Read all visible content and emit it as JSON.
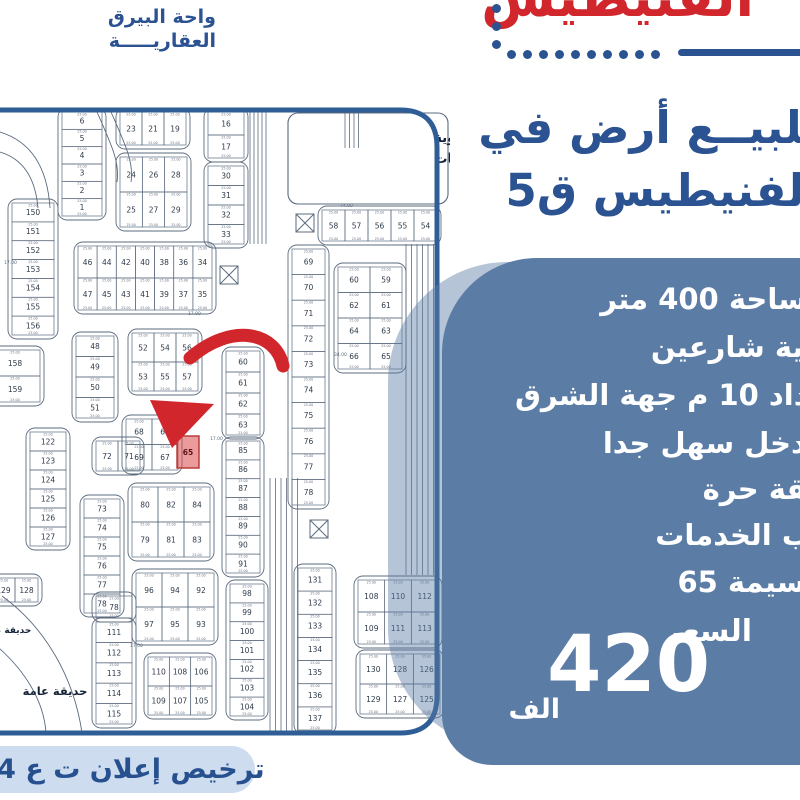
{
  "colors": {
    "accent_red": "#d0262c",
    "brand_blue": "#2b5291",
    "panel_blue": "#5b7ca5",
    "license_bg": "#cddcee",
    "license_text": "#27508f",
    "map_border": "#2f5e96",
    "map_line": "#5b6b7e",
    "highlight_red": "#d24040"
  },
  "brand": {
    "line1": "واحة البيرق",
    "line2": "العقاريـــــة"
  },
  "header": {
    "red_title": "الفنيطيس",
    "title_line1": "للبيــع أرض في",
    "title_line2": "الفنيطيس ق5",
    "dots_vertical": 3,
    "dots_horizontal": 10
  },
  "panel": {
    "features": [
      "المساحة 400 متر",
      "زاوية شارعين",
      "ارتداد 10 م جهة الشرق",
      "المدخل سهل جدا",
      "وثيقة حرة",
      "قرب الخدمات",
      "القسيمة 65"
    ],
    "feature_tops": [
      24,
      72,
      120,
      168,
      214,
      260,
      307
    ],
    "price_label": "السعر",
    "price_value": "420",
    "price_unit": "الف"
  },
  "license": {
    "text": "ترخيص إعلان ت ع 64"
  },
  "map": {
    "school_label": [
      "رسة ثانوية",
      "بنات"
    ],
    "garden_label": "حديقة عامة",
    "garden_label_small": "حديقة عامة",
    "dim_label": "25.00",
    "highlight": {
      "number": "65",
      "x": 177,
      "y": 436,
      "w": 22,
      "h": 32
    },
    "floating_dims": [
      [
        "17.00",
        210,
        440
      ],
      [
        "74.00",
        340,
        207
      ],
      [
        "17.00",
        4,
        264
      ],
      [
        "34.00",
        334,
        356
      ],
      [
        "17.00",
        130,
        647
      ],
      [
        "17.00",
        188,
        315
      ]
    ],
    "school_rect": [
      288,
      113,
      160,
      91
    ],
    "xboxes": [
      [
        296,
        214
      ],
      [
        220,
        266
      ],
      [
        310,
        520
      ]
    ],
    "roads": [
      [
        250,
        112,
        244,
        5,
        4
      ],
      [
        345,
        112,
        148,
        4,
        4.5
      ],
      [
        270,
        478,
        733,
        6,
        5.5
      ],
      [
        406,
        244,
        575,
        6,
        5.5
      ]
    ],
    "curves": [
      "M0,152 Q34,162 38,208",
      "M0,132 Q46,146 50,208",
      "M97,112 C112,146 120,163 117,182",
      "M111,112 C126,146 134,163 131,182",
      "M2,596 C46,628 74,678 82,733",
      "M-8,642 C26,670 44,702 46,733"
    ],
    "arrow": {
      "tail": "M283,366 C276,332 232,322 190,358",
      "head": "150,400 214,404 172,448"
    },
    "blocks": [
      [
        62,
        112,
        40,
        104,
        1,
        6,
        [
          "6",
          "5",
          "4",
          "3",
          "2",
          "1"
        ]
      ],
      [
        120,
        112,
        66,
        33,
        3,
        1,
        [
          "23",
          "21",
          "19"
        ]
      ],
      [
        120,
        157,
        67,
        70,
        3,
        2,
        [
          "24",
          "26",
          "28",
          "25",
          "27",
          "29"
        ]
      ],
      [
        208,
        112,
        36,
        46,
        1,
        2,
        [
          "16",
          "17"
        ]
      ],
      [
        208,
        166,
        36,
        78,
        1,
        4,
        [
          "30",
          "31",
          "32",
          "33"
        ]
      ],
      [
        322,
        210,
        115,
        31,
        5,
        1,
        [
          "58",
          "57",
          "56",
          "55",
          "54"
        ]
      ],
      [
        12,
        203,
        42,
        132,
        1,
        7,
        [
          "150",
          "151",
          "152",
          "153",
          "154",
          "155",
          "156"
        ]
      ],
      [
        -10,
        350,
        50,
        52,
        1,
        2,
        [
          "158",
          "159"
        ]
      ],
      [
        76,
        336,
        38,
        82,
        1,
        4,
        [
          "48",
          "49",
          "50",
          "51"
        ]
      ],
      [
        132,
        333,
        66,
        58,
        3,
        2,
        [
          "52",
          "54",
          "56",
          "53",
          "55",
          "57"
        ]
      ],
      [
        96,
        441,
        44,
        30,
        2,
        1,
        [
          "72",
          "71"
        ]
      ],
      [
        126,
        419,
        52,
        51,
        2,
        2,
        [
          "68",
          "66",
          "69",
          "67"
        ]
      ],
      [
        226,
        351,
        34,
        84,
        1,
        4,
        [
          "60",
          "61",
          "62",
          "63"
        ]
      ],
      [
        226,
        441,
        34,
        132,
        1,
        7,
        [
          "85",
          "86",
          "87",
          "88",
          "89",
          "90",
          "91"
        ]
      ],
      [
        230,
        584,
        34,
        132,
        1,
        7,
        [
          "98",
          "99",
          "100",
          "101",
          "102",
          "103",
          "104"
        ]
      ],
      [
        292,
        249,
        33,
        256,
        1,
        10,
        [
          "69",
          "70",
          "71",
          "72",
          "73",
          "74",
          "75",
          "76",
          "77",
          "78"
        ]
      ],
      [
        338,
        267,
        64,
        102,
        2,
        4,
        [
          "60",
          "59",
          "62",
          "61",
          "64",
          "63",
          "66",
          "65"
        ]
      ],
      [
        78,
        246,
        134,
        64,
        7,
        2,
        [
          "46",
          "44",
          "42",
          "40",
          "38",
          "36",
          "34",
          "47",
          "45",
          "43",
          "41",
          "39",
          "37",
          "35"
        ]
      ],
      [
        132,
        487,
        78,
        70,
        3,
        2,
        [
          "80",
          "82",
          "84",
          "79",
          "81",
          "83"
        ]
      ],
      [
        136,
        573,
        78,
        68,
        3,
        2,
        [
          "96",
          "94",
          "92",
          "97",
          "95",
          "93"
        ]
      ],
      [
        148,
        657,
        64,
        58,
        3,
        2,
        [
          "110",
          "108",
          "106",
          "109",
          "107",
          "105"
        ]
      ],
      [
        96,
        622,
        36,
        102,
        1,
        5,
        [
          "111",
          "112",
          "113",
          "114",
          "115"
        ]
      ],
      [
        96,
        596,
        36,
        22,
        1,
        1,
        [
          "78"
        ]
      ],
      [
        30,
        432,
        36,
        114,
        1,
        6,
        [
          "122",
          "123",
          "124",
          "125",
          "126",
          "127"
        ]
      ],
      [
        84,
        499,
        36,
        114,
        1,
        6,
        [
          "73",
          "74",
          "75",
          "76",
          "77",
          "78"
        ]
      ],
      [
        -8,
        578,
        46,
        24,
        2,
        1,
        [
          "129",
          "128"
        ]
      ],
      [
        298,
        568,
        34,
        162,
        1,
        7,
        [
          "131",
          "132",
          "133",
          "134",
          "135",
          "136",
          "137"
        ]
      ],
      [
        358,
        580,
        80,
        64,
        3,
        2,
        [
          "108",
          "110",
          "112",
          "109",
          "111",
          "113"
        ]
      ],
      [
        360,
        654,
        80,
        60,
        3,
        2,
        [
          "130",
          "128",
          "126",
          "129",
          "127",
          "125"
        ]
      ]
    ]
  }
}
